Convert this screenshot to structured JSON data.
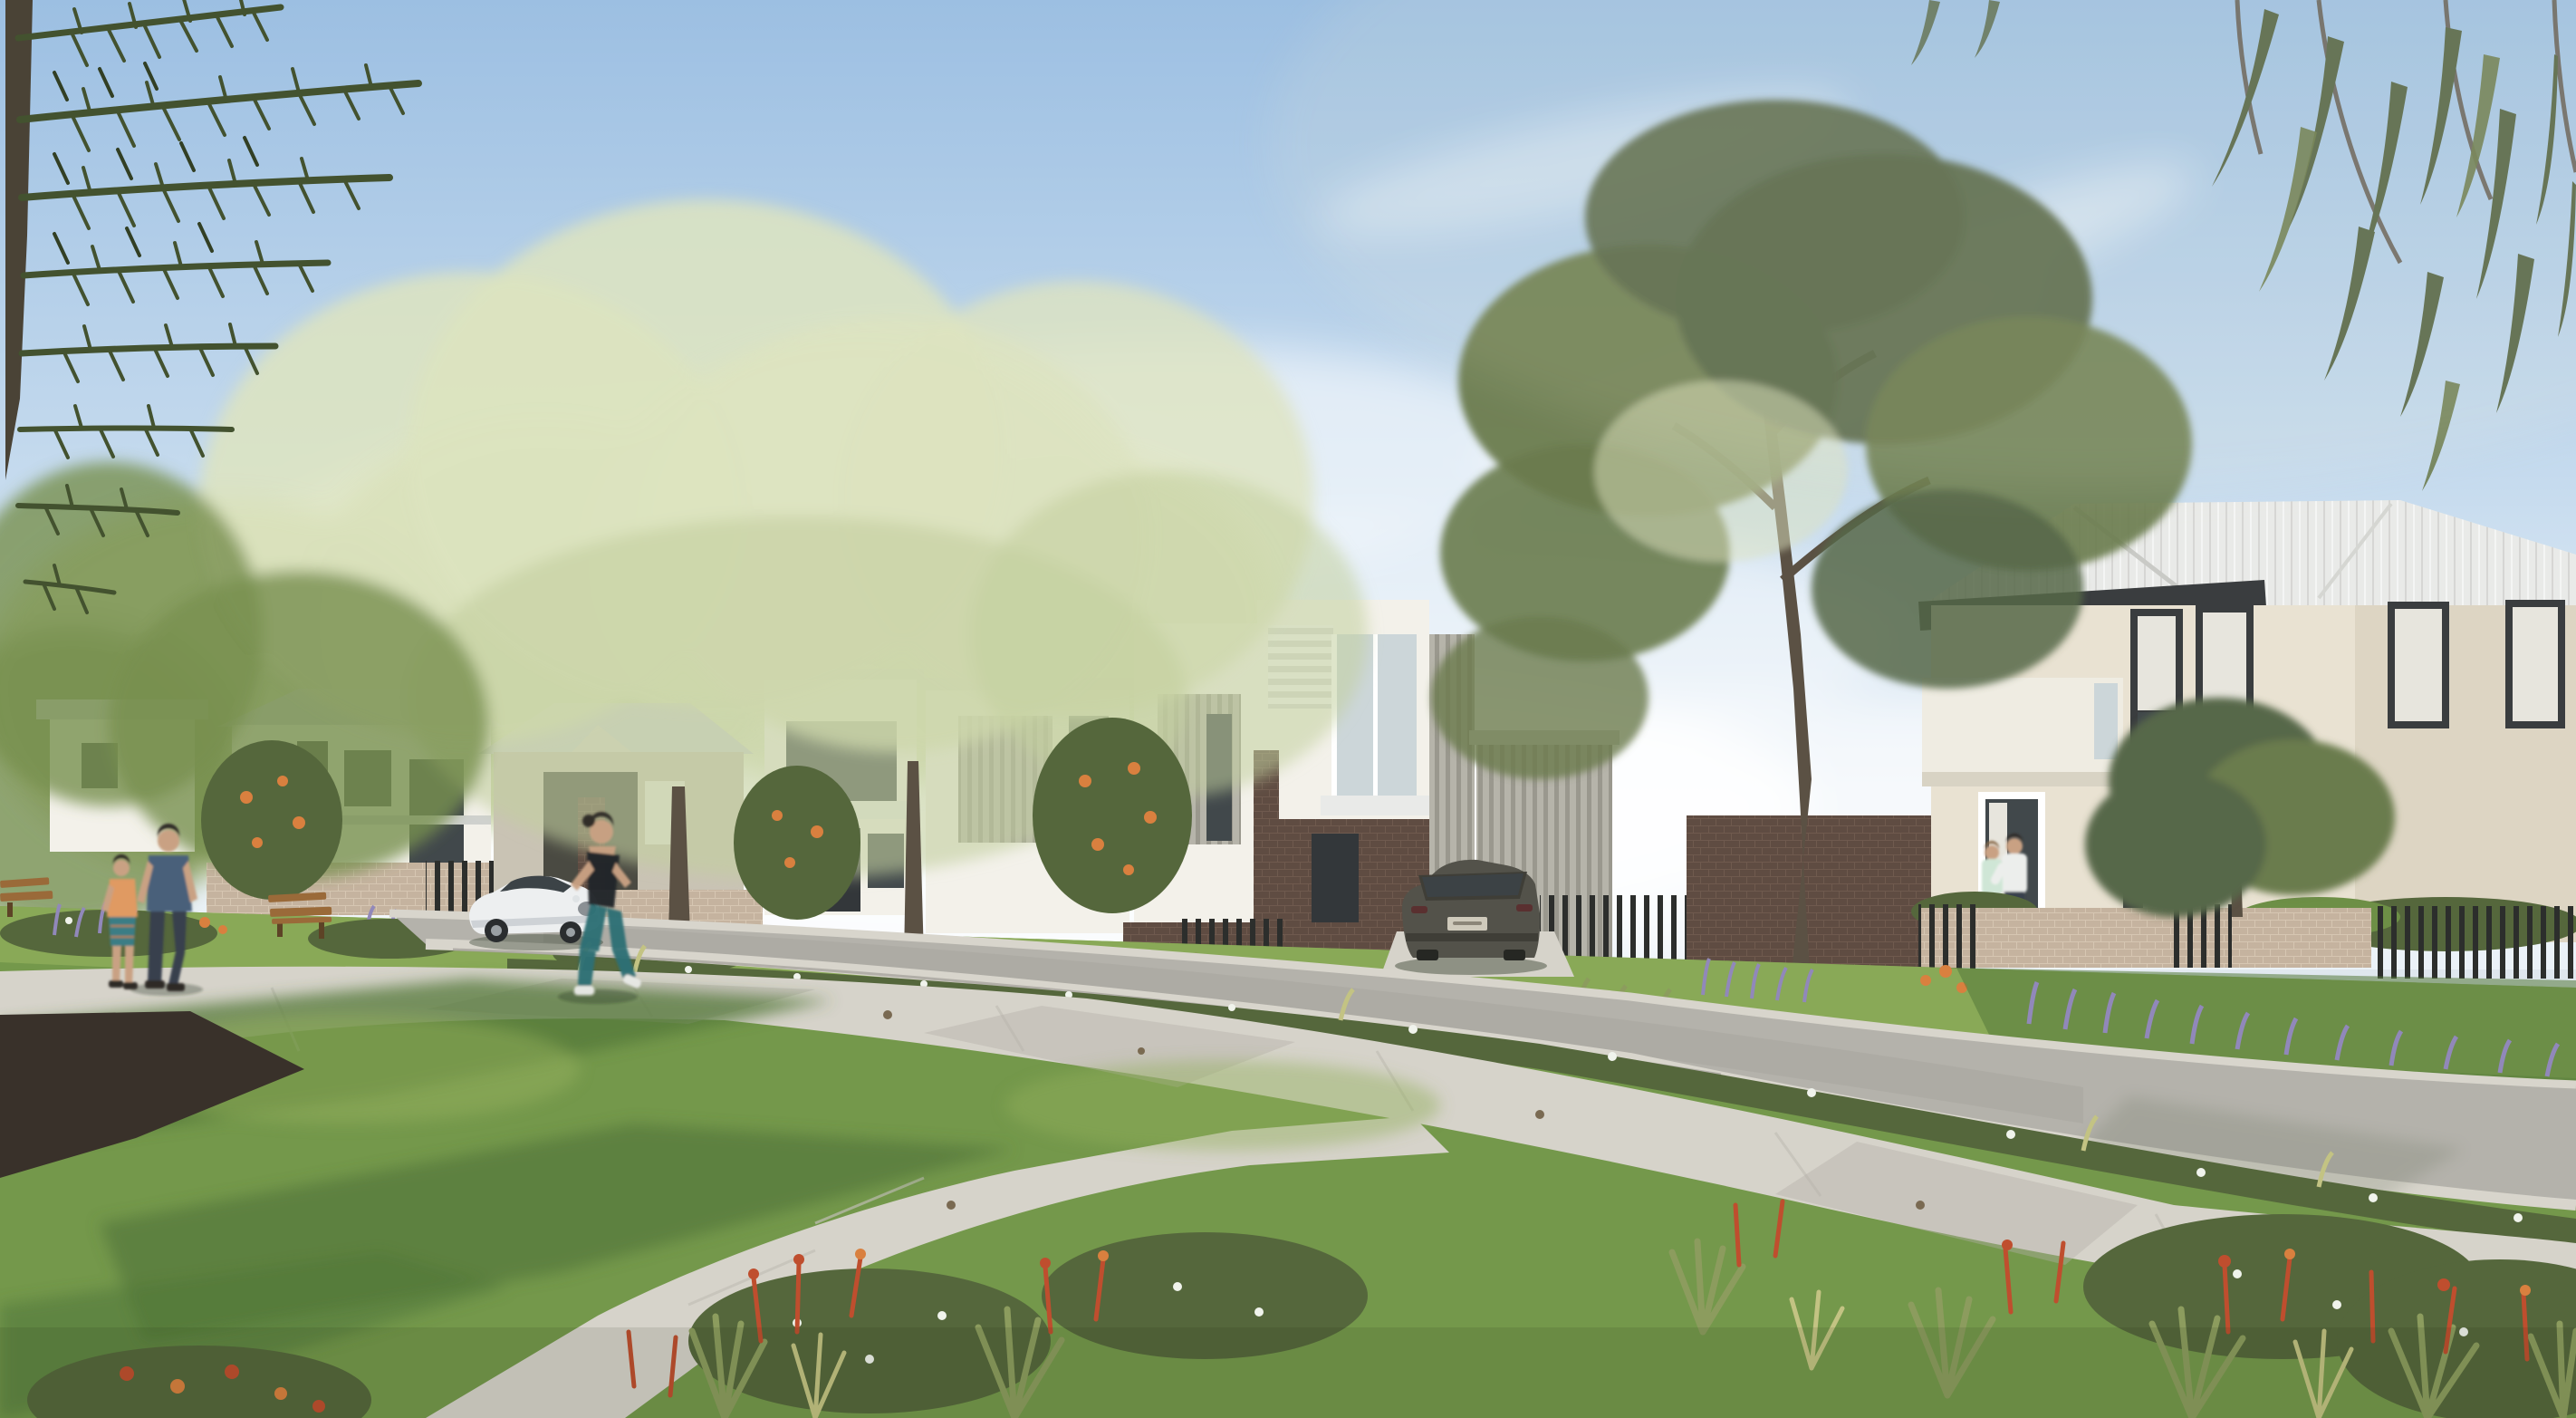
{
  "meta": {
    "image_type": "photorealistic architectural streetscape render",
    "visible_text": "none",
    "time_of_day": "late afternoon sun from upper right",
    "sky": "clear blue with wispy cirrus cloud"
  },
  "scene": {
    "houses": [
      "white two-storey townhouse behind trees (far left)",
      "sunlit hip-roof house veiled by backlit foliage (centre left)",
      "white two-storey townhouse with balcony and dark entry (centre)",
      "modern townhouse with white louvre box, glass balcony, dark brick base and grey vertical cladding (centre right)",
      "large two-storey cream-brick home with white metal hip roof, dark fascia, rendered balcony box and black framed windows (right)"
    ],
    "vehicles": [
      "white coupe driving on street (centre left)",
      "olive-grey wagon parked on driveway (centre right)"
    ],
    "people": [
      "man in blue t-shirt walking with boy in orange t-shirt on park path (left)",
      "female jogger in black tank and teal leggings, motion blurred (centre left)",
      "couple embracing at entry of right house"
    ],
    "street_furniture": [
      "timber park bench",
      "partial timber bench at left edge"
    ],
    "landscape": [
      "norfolk-pine overhanging top left",
      "eucalyptus leaves overhanging top right",
      "tall eucalyptus street tree centre right",
      "parkland lawn with mulch bed and tree shadows",
      "diagonal concrete footpaths",
      "native garden beds with flax, red flower spikes, white groundcover flowers and lavender",
      "brick front fences with black slat infills",
      "curving asphalt street with concrete kerbs"
    ]
  },
  "colors": {
    "sky_top": "#9cbfe2",
    "sky_mid": "#c6dbee",
    "sky_low": "#ebf2f8",
    "cloud": "#ffffff",
    "pine": "#43522f",
    "pine_dark": "#323f24",
    "leaf_dark": "#55673c",
    "leaf_mid": "#78904f",
    "leaf_pale": "#c3cf9f",
    "leaf_sunlit": "#dde4c0",
    "euc": "#6a7b4e",
    "euc_dark": "#566749",
    "trunk": "#5b5144",
    "roof_white": "#e9eae8",
    "roof_shadow": "#cfd1ce",
    "fascia": "#3a3d3f",
    "charcoal": "#33373a",
    "wall_white": "#f3f1ea",
    "wall_cream": "#e9e2d2",
    "cladding": "#b6b4aa",
    "clad_dark": "#9a988e",
    "glass_dark": "#41484b",
    "glass_light": "#ccd6d9",
    "curtain": "#e7e5dd",
    "brick_dark": "#5f4c42",
    "brick_dark_mortar": "#6f5a4e",
    "brick_light": "#c5b39f",
    "brick_light_mortar": "#d6c6b2",
    "lawn_light": "#93b05c",
    "lawn_mid": "#74984b",
    "lawn_dark": "#54783a",
    "hedge": "#6d8f46",
    "path": "#d6d3ca",
    "path_shadow": "#b3b0a7",
    "road": "#b4b2ab",
    "road_dark": "#a19f98",
    "kerb": "#d8d5cc",
    "mulch": "#39312a",
    "grass_olive": "#8c9c5e",
    "grass_yellow": "#c3c383",
    "lavender": "#9188ba",
    "flower_red": "#bf4e2e",
    "flower_orange": "#d9803f",
    "flower_white": "#f0f3ec",
    "car_white": "#edeff0",
    "car_shadow": "#c6cbd0",
    "car_glass": "#3c4347",
    "car_olive": "#53524a",
    "car_olive_dark": "#3f3e37",
    "skin": "#c9a183",
    "hair_dark": "#2e2a26",
    "shirt_blue": "#48617a",
    "jeans": "#39414e",
    "shirt_orange": "#e09a62",
    "shorts_teal": "#3a7d85",
    "tank_black": "#22262a",
    "leggings_teal": "#2e6f74",
    "shoe_white": "#e8e9e6",
    "shirt_white": "#eceeec",
    "top_mint": "#cfe6d6",
    "pants_light": "#dfe0da",
    "bench_wood": "#9a6a39",
    "bench_dark": "#5d4326"
  }
}
